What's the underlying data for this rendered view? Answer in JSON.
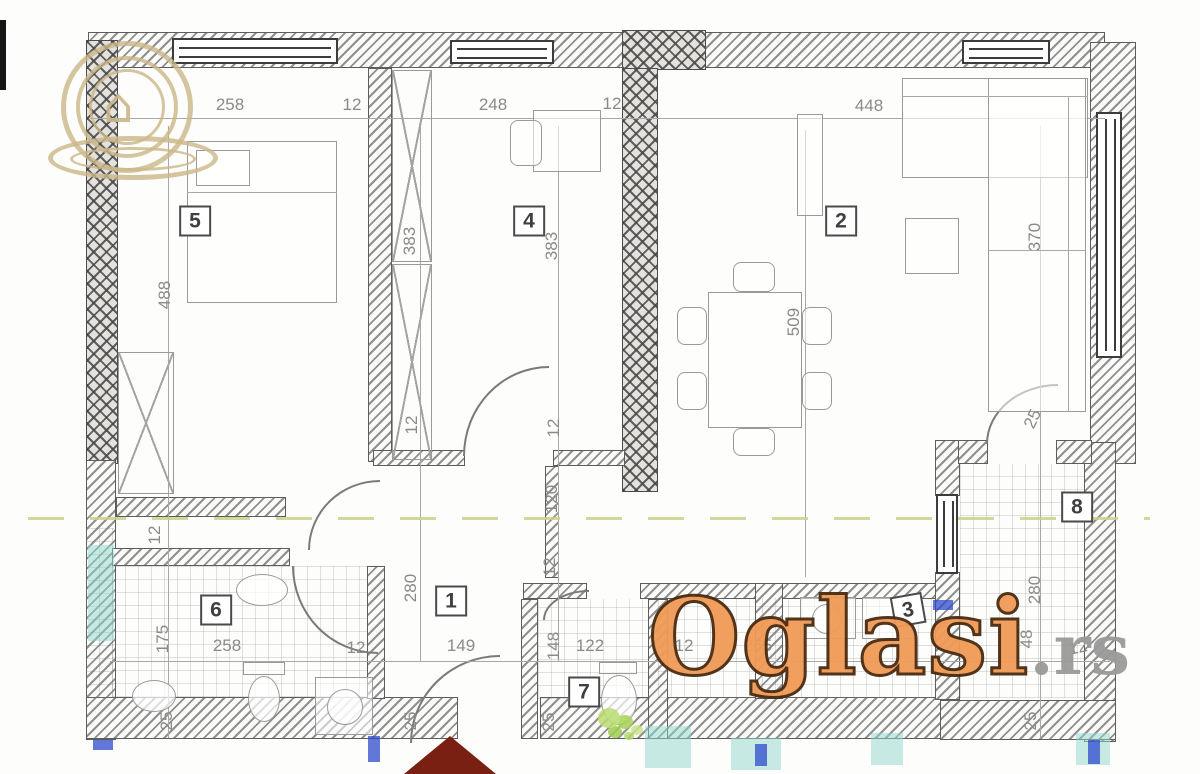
{
  "colors": {
    "watermark_orange": "#F09B56",
    "watermark_outline": "#4A2A10",
    "watermark_suffix_gray": "#9A9A9A",
    "logo_tan": "#CBB688",
    "section_line_olive": "#CDD08B",
    "roof_maroon": "#7A2013",
    "teal_mark": "#8FD8CC",
    "blue_mark": "#2E4ACB",
    "dimension_gray": "#8A8A8A",
    "wall_dark": "#4A4A4A"
  },
  "watermark": {
    "brand": "Oglasi",
    "suffix": ".rs",
    "house_glyph": "⌂"
  },
  "rooms": [
    {
      "number": "1"
    },
    {
      "number": "2"
    },
    {
      "number": "3"
    },
    {
      "number": "4"
    },
    {
      "number": "5"
    },
    {
      "number": "6"
    },
    {
      "number": "7"
    },
    {
      "number": "8"
    }
  ],
  "dims": {
    "w_room5": "258",
    "wall12_a": "12",
    "w_room4": "248",
    "wall12_b": "12",
    "w_room2": "448",
    "h_room5": "488",
    "h_room4_l": "383",
    "h_room4_r": "383",
    "h_sofa": "370",
    "h_dining": "509",
    "t12_a": "12",
    "t12_b": "12",
    "hall_120": "120",
    "t12_c": "12",
    "t12_d": "12",
    "h_hall_280": "280",
    "h_room8_280": "280",
    "h_bath_175": "175",
    "h_wc_148": "148",
    "d25_a": "25",
    "d25_b": "25",
    "d25_c": "25",
    "d25_d": "25",
    "d25_door8": "25",
    "b_258": "258",
    "b_12a": "12",
    "b_149": "149",
    "b_122": "122",
    "b_12b": "12",
    "b_265": "265",
    "b_48": "48",
    "b_12c": "12"
  }
}
